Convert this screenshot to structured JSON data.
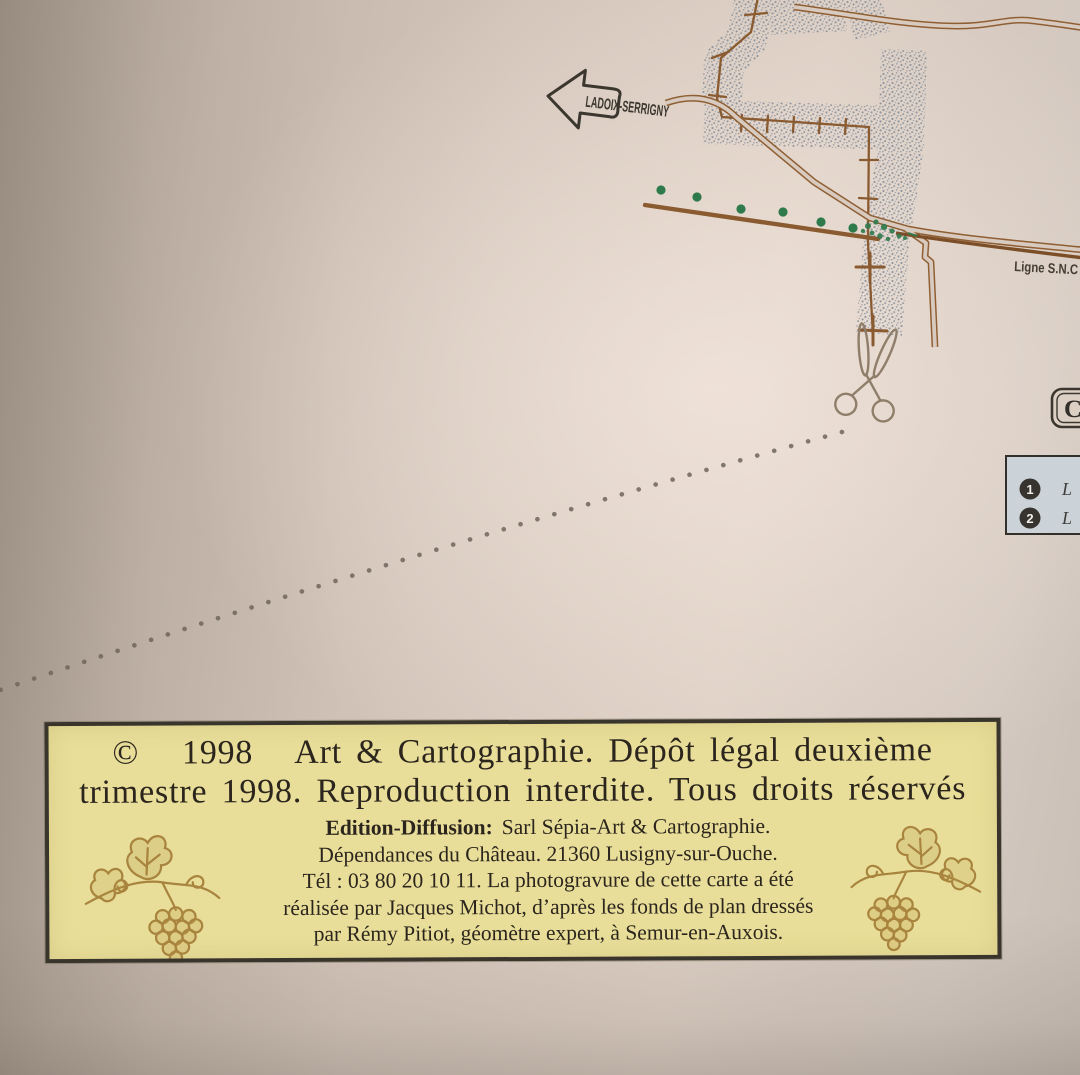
{
  "map": {
    "road_sign_label": "LADOIX-SERRIGNY",
    "railway_label": "Ligne S.N.C",
    "cartouche_letter": "C",
    "legend_items": [
      {
        "number": "1",
        "label": "L"
      },
      {
        "number": "2",
        "label": "L"
      }
    ]
  },
  "copyright_box": {
    "line1": "©   1998   Art & Cartographie. Dépôt légal deuxième",
    "line2": "trimestre 1998. Reproduction interdite. Tous droits réservés",
    "edition_label": "Edition-Diffusion:",
    "edition_text": "Sarl Sépia-Art & Cartographie.",
    "address_line": "Dépendances du Château. 21360 Lusigny-sur-Ouche.",
    "phone_line": "Tél : 03 80 20 10 11. La photogravure de cette carte a été",
    "credit_line_1": "réalisée par Jacques Michot, d’après les fonds de plan dressés",
    "credit_line_2": "par Rémy Pitiot, géomètre expert, à Semur-en-Auxois."
  },
  "colors": {
    "paper": "#d8cabf",
    "copyright_fill": "#e8de99",
    "ink_dark": "#39352d",
    "road_brown": "#8f5f33",
    "railway_brown": "#7c4e28",
    "tree_green": "#2e7a4b",
    "stipple_gray": "#8e96a0",
    "legend_bg": "#ccd3d8",
    "vine_gold": "#a8843e"
  }
}
